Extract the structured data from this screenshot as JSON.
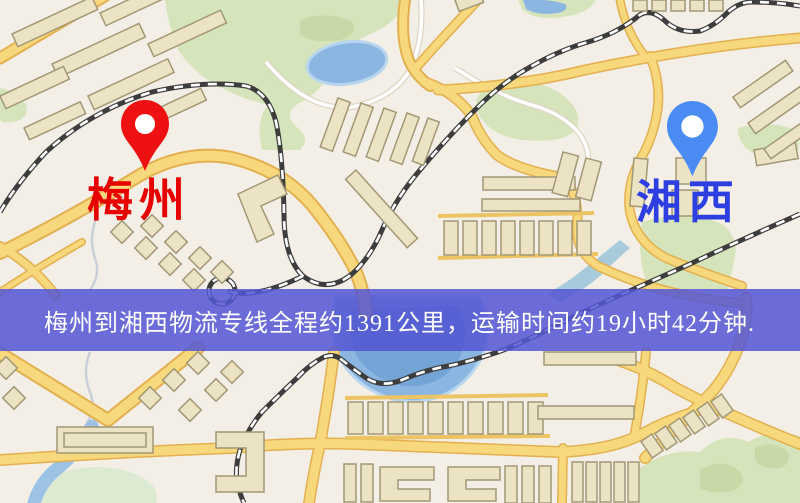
{
  "banner": {
    "text": "梅州到湘西物流专线全程约1391公里，运输时间约19小时42分钟.",
    "background": "#5456d4",
    "opacity": "0.86",
    "text_color": "#ffffff"
  },
  "markers": {
    "origin": {
      "label": "梅州",
      "pin_color": "#ed1111",
      "label_color": "#e60000",
      "icon": "map-pin"
    },
    "destination": {
      "label": "湘西",
      "pin_color": "#4b8cf4",
      "label_color": "#2e3fe2",
      "icon": "map-pin"
    }
  },
  "map": {
    "colors": {
      "background": "#f4efe6",
      "road_fill": "#f8d87c",
      "road_casing": "#e3b050",
      "thin_road": "#ecc463",
      "building_fill": "#ece3c4",
      "building_stroke": "#a29876",
      "park": "#d5e4ba",
      "park_dark": "#c6d9a6",
      "pond_pale": "#dcead2",
      "water": "#8cb6e2",
      "water_deep": "#74a3d6",
      "water_light": "#9cc2e6",
      "stream_gray": "#c9cfd8",
      "railway": "#3d3d3d",
      "railway_dash": "#ffffff",
      "minor_road": "#ffffff",
      "minor_road_casing": "#ded5c4",
      "pin_hole": "#ffffff"
    }
  }
}
